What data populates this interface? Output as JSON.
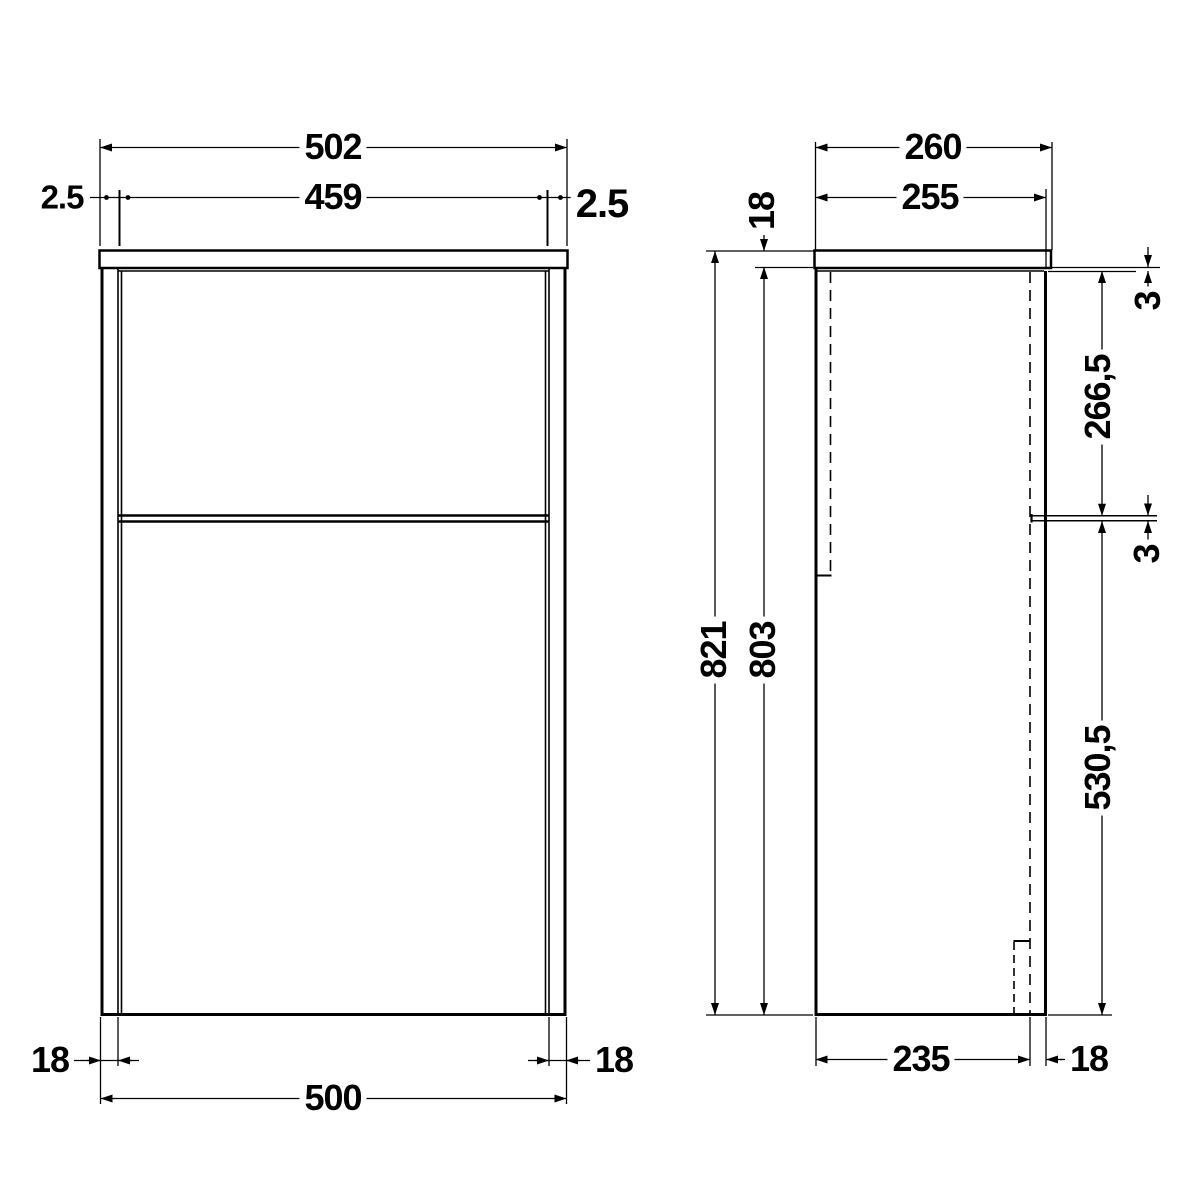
{
  "page": {
    "background": "#ffffff",
    "line_color": "#000000",
    "drawing_type": "cabinet technical drawing, front and side elevation"
  },
  "front": {
    "countertop_width": "502",
    "door_width": "459",
    "gap_left": "2.5",
    "gap_right": "2.5",
    "panel_left": "18",
    "panel_right": "18",
    "cabinet_width": "500"
  },
  "side": {
    "countertop_depth": "260",
    "front_depth": "255",
    "countertop_thickness": "18",
    "total_height": "821",
    "carcass_height": "803",
    "top_gap": "3",
    "upper_panel_height": "266,5",
    "middle_gap": "3",
    "lower_panel_height": "530,5",
    "carcass_depth": "235",
    "door_thickness": "18"
  }
}
